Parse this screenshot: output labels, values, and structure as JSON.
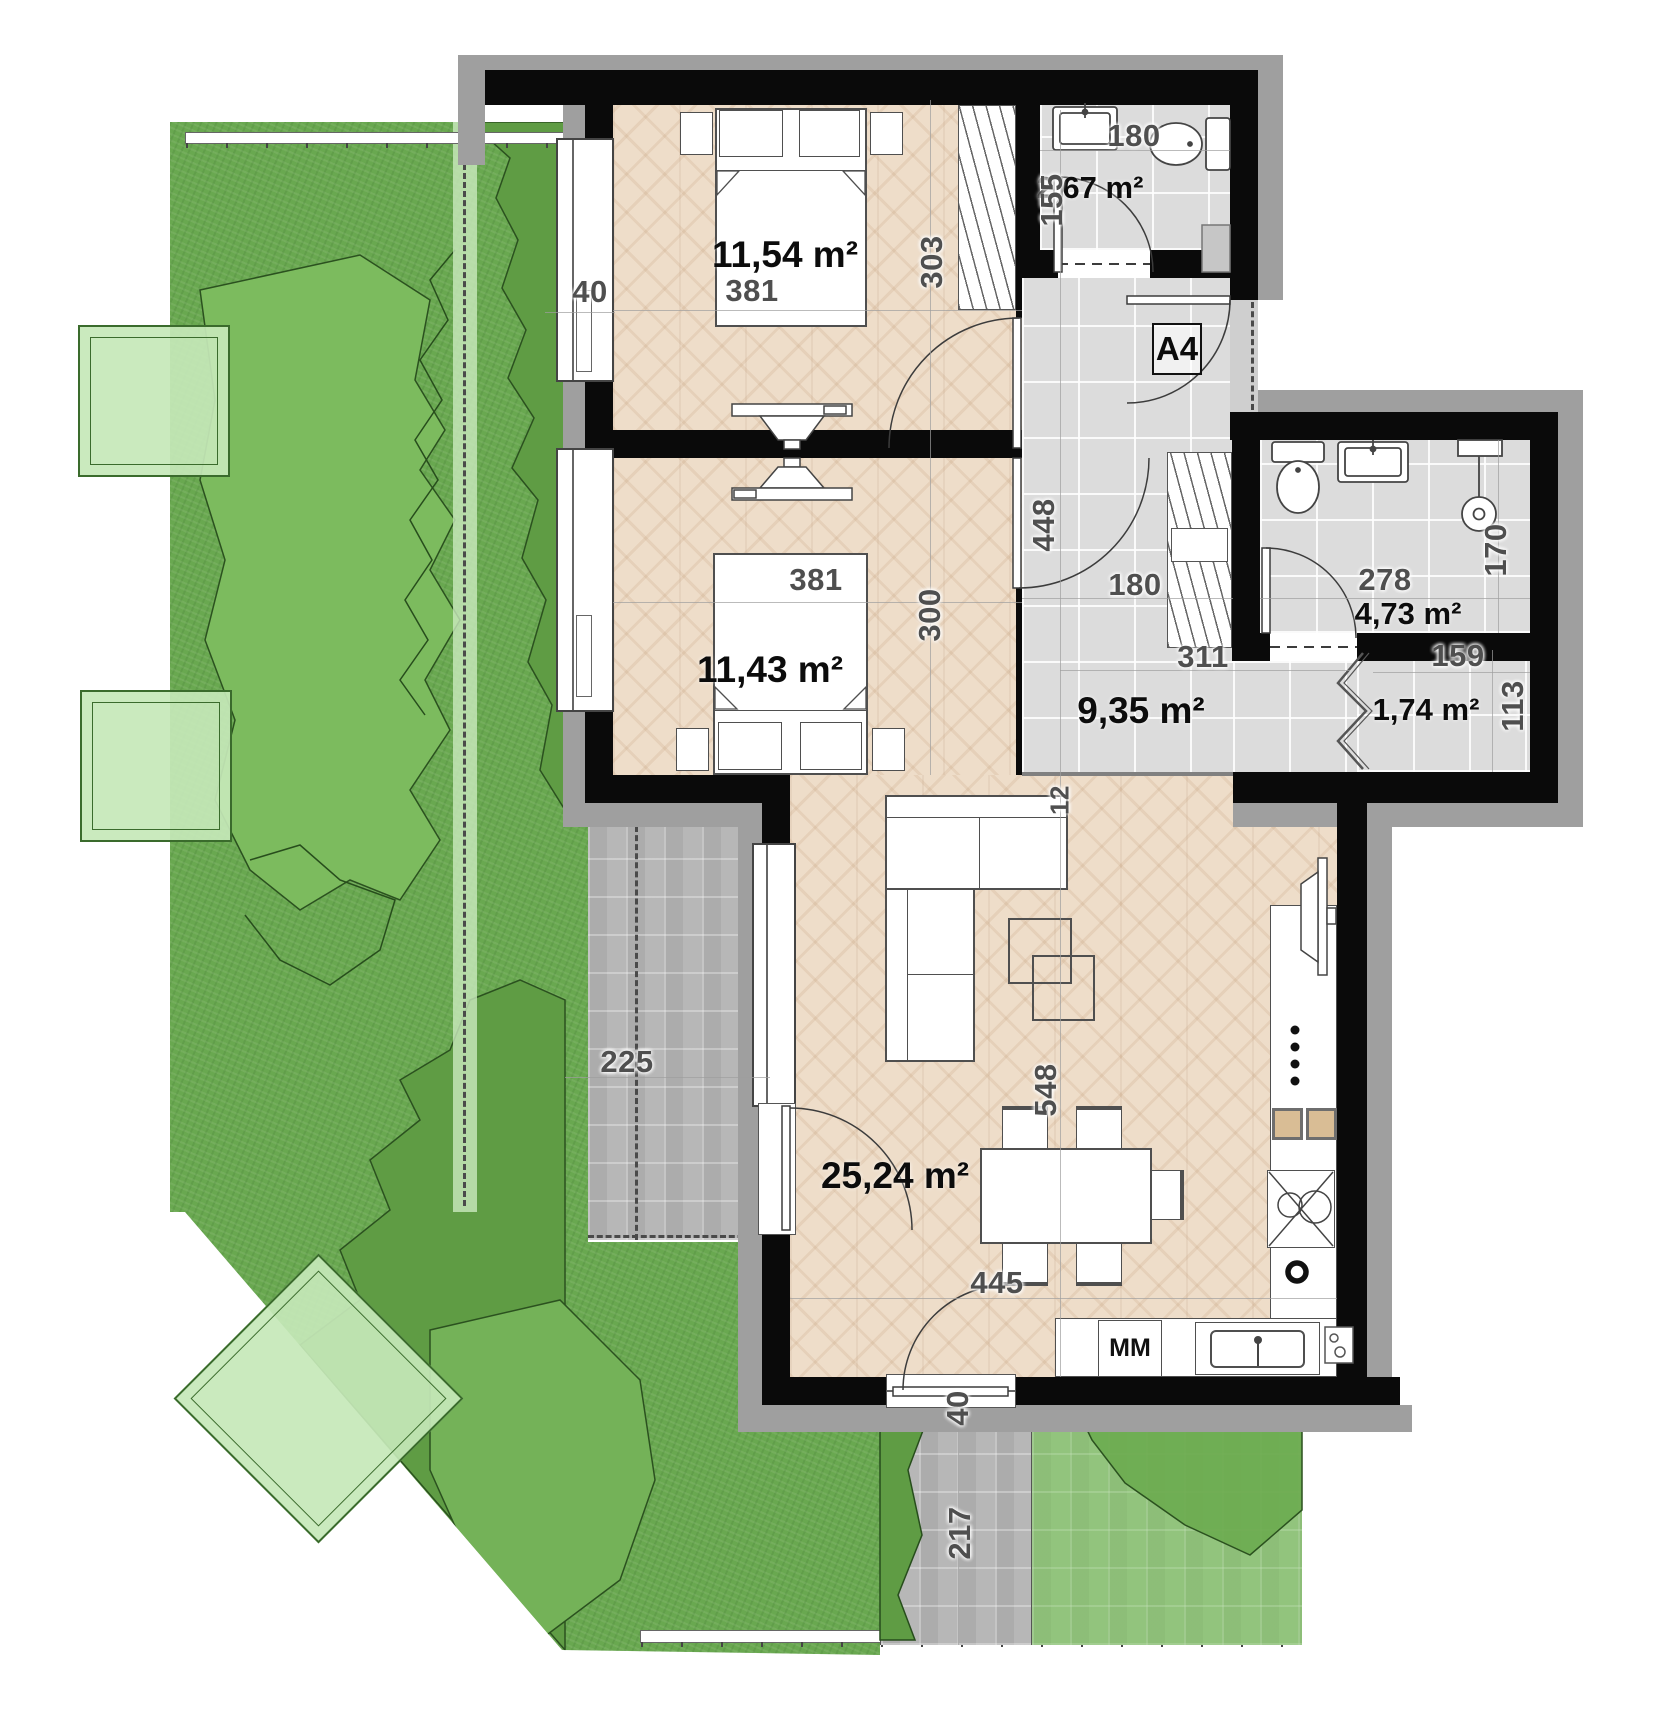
{
  "plan": {
    "unit": "A4",
    "rooms": {
      "bedroom1": {
        "area": "11,54 m²"
      },
      "wc": {
        "area": "2,67 m²"
      },
      "bedroom2": {
        "area": "11,43 m²"
      },
      "hall": {
        "area": "9,35 m²"
      },
      "bathroom": {
        "area": "4,73 m²"
      },
      "closet": {
        "area": "1,74 m²"
      },
      "living": {
        "area": "25,24 m²"
      }
    },
    "dims": {
      "bed1_window": "40",
      "bed1_width": "381",
      "bed1_height": "303",
      "bed2_width": "381",
      "bed2_height": "300",
      "wc_width": "180",
      "wc_height": "155",
      "hall_height": "448",
      "hall_width": "180",
      "hall_length": "311",
      "hall_step": "12",
      "bath_width": "278",
      "bath_height": "170",
      "closet_width": "159",
      "closet_height": "113",
      "living_height": "548",
      "living_width": "445",
      "living_door": "40",
      "terrace_width": "225",
      "path_width": "217"
    },
    "kitchen": {
      "mm_label": "MM"
    },
    "colors": {
      "wall": "#0a0a0a",
      "wood": "#eeddc9",
      "tile": "#dcdcdc",
      "grass": "#69a850",
      "paver": "#b7b7b7",
      "planter": "#cdeac0"
    }
  }
}
